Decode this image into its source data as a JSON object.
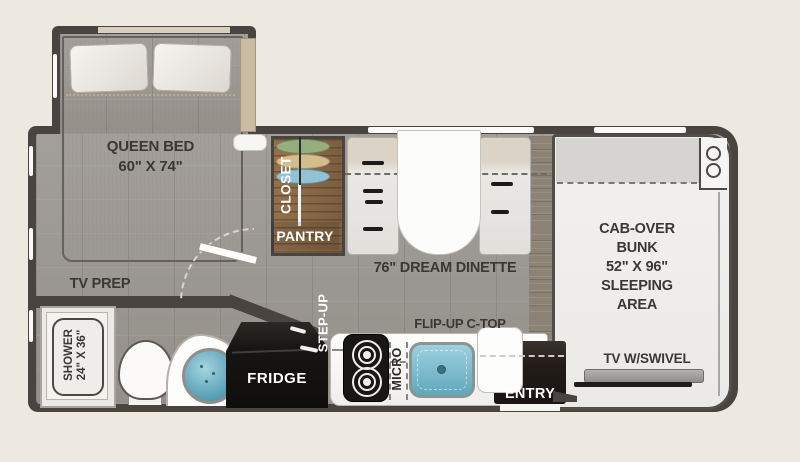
{
  "colors": {
    "background": "#EDE8E0",
    "wall": "#4A4441",
    "floor": "#9C9894",
    "closet_wood": "#8A6A49",
    "sink_teal": "#6FB5C9",
    "label_dark": "#3A3734",
    "label_light": "#FFFFFF"
  },
  "labels": {
    "queen_bed": [
      "QUEEN BED",
      "60\" X 74\""
    ],
    "tv_prep": "TV PREP",
    "shower": [
      "SHOWER",
      "24\" X 36\""
    ],
    "closet": "CLOSET",
    "pantry": "PANTRY",
    "step_up": "STEP-UP",
    "dinette": "76\" DREAM DINETTE",
    "flip_up_ctop": "FLIP-UP C-TOP",
    "fridge": "FRIDGE",
    "micro": "MICRO",
    "entry": "ENTRY",
    "cab_over": [
      "CAB-OVER",
      "BUNK",
      "52\" X 96\"",
      "SLEEPING",
      "AREA"
    ],
    "tv_swivel": "TV W/SWIVEL"
  }
}
